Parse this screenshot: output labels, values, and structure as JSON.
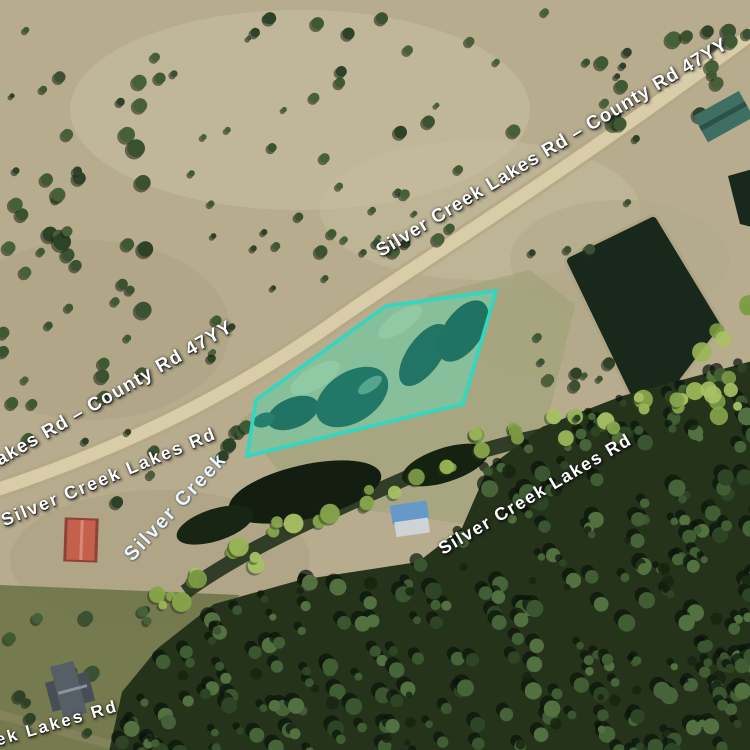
{
  "app": {
    "view": "satellite-map"
  },
  "map": {
    "road_labels": [
      {
        "id": "road-label-top",
        "text": "Silver Creek Lakes Rd – County Rd 47YY"
      },
      {
        "id": "road-label-left-upper",
        "text": "Lakes Rd – County Rd 47YY"
      },
      {
        "id": "road-label-left-lower",
        "text": "Silver Creek Lakes Rd"
      },
      {
        "id": "road-label-mid-right",
        "text": "Silver Creek Lakes Rd"
      },
      {
        "id": "road-label-bottom-left",
        "text": "ek Lakes Rd"
      }
    ],
    "water_labels": [
      {
        "id": "water-label-silver-creek",
        "text": "Silver Creek"
      }
    ],
    "parcel": {
      "stroke_color": "#2fd8c2",
      "fill_color": "rgba(47,216,194,0.26)",
      "points": "496,291 386,306 256,400 247,456 463,404"
    }
  }
}
